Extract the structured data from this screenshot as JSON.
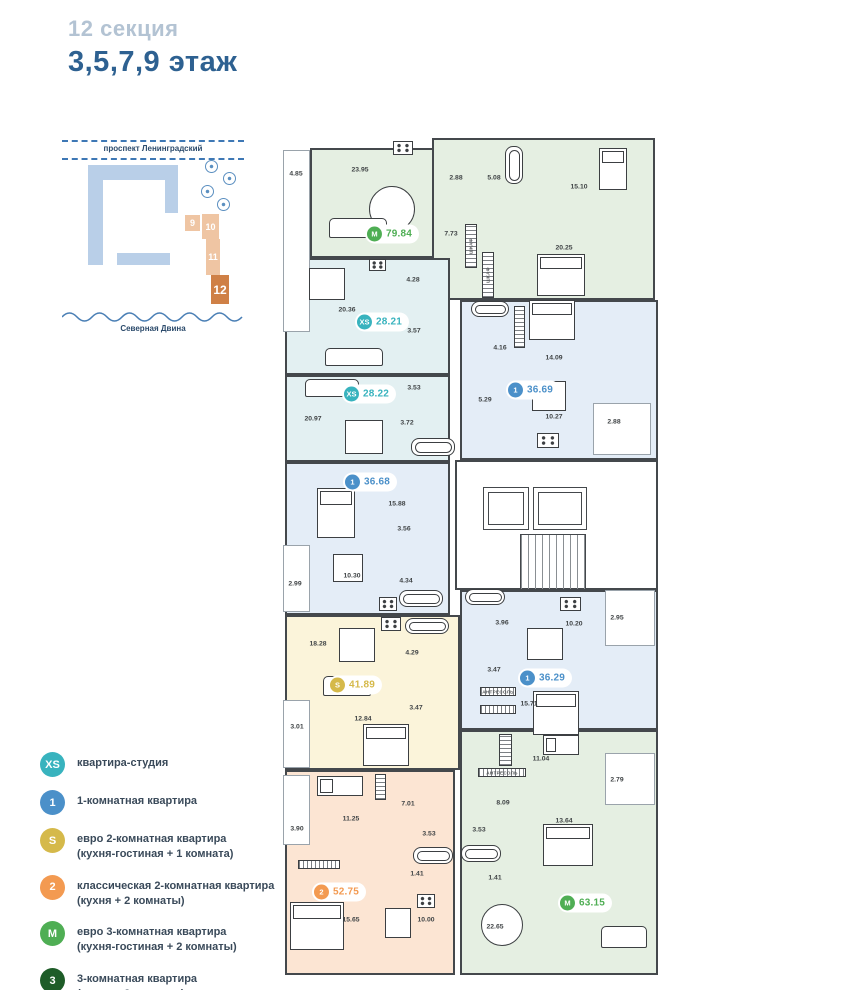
{
  "header": {
    "section_label": "12 секция",
    "floor_label": "3,5,7,9 этаж"
  },
  "site_map": {
    "street_label": "проспект Ленинградский",
    "river_label": "Северная Двина",
    "sections": [
      {
        "label": "9",
        "active": false,
        "x": 123,
        "y": 79,
        "w": 15,
        "h": 16
      },
      {
        "label": "10",
        "active": false,
        "x": 140,
        "y": 78,
        "w": 17,
        "h": 25
      },
      {
        "label": "11",
        "active": false,
        "x": 144,
        "y": 103,
        "w": 14,
        "h": 36
      },
      {
        "label": "12",
        "active": true,
        "x": 149,
        "y": 139,
        "w": 18,
        "h": 29
      }
    ]
  },
  "legend": {
    "items": [
      {
        "code": "XS",
        "color": "#38b3be",
        "line1": "квартира-студия",
        "line2": ""
      },
      {
        "code": "1",
        "color": "#4b90c9",
        "line1": "1-комнатная квартира",
        "line2": ""
      },
      {
        "code": "S",
        "color": "#d5b94a",
        "line1": "евро 2-комнатная квартира",
        "line2": "(кухня-гостиная + 1 комната)"
      },
      {
        "code": "2",
        "color": "#f39a51",
        "line1": "классическая 2-комнатная квартира",
        "line2": "(кухня + 2 комнаты)"
      },
      {
        "code": "M",
        "color": "#4fae54",
        "line1": "евро 3-комнатная квартира",
        "line2": "(кухня-гостиная + 2 комнаты)"
      },
      {
        "code": "3",
        "color": "#1e5c28",
        "line1": "3-комнатная квартира",
        "line2": "(кухня + 3 комнаты)"
      }
    ]
  },
  "types": {
    "XS": {
      "fill": "#e3f0f2",
      "accent": "#38b3be"
    },
    "1": {
      "fill": "#e4edf7",
      "accent": "#4b90c9"
    },
    "S": {
      "fill": "#fbf4da",
      "accent": "#d5b94a"
    },
    "2": {
      "fill": "#fce5d3",
      "accent": "#f39a51"
    },
    "M": {
      "fill": "#e5efe2",
      "accent": "#4fae54"
    }
  },
  "plan": {
    "regions": [
      {
        "k": "M",
        "x": 27,
        "y": 10,
        "w": 150,
        "h": 110
      },
      {
        "k": "M",
        "x": 149,
        "y": 0,
        "w": 223,
        "h": 162
      },
      {
        "k": "XS",
        "x": 2,
        "y": 120,
        "w": 165,
        "h": 117
      },
      {
        "k": "XS",
        "x": 2,
        "y": 237,
        "w": 165,
        "h": 87
      },
      {
        "k": "1",
        "x": 177,
        "y": 162,
        "w": 198,
        "h": 160
      },
      {
        "k": "1",
        "x": 2,
        "y": 324,
        "w": 165,
        "h": 153
      },
      {
        "k": "1",
        "x": 177,
        "y": 452,
        "w": 198,
        "h": 140
      },
      {
        "k": "S",
        "x": 2,
        "y": 477,
        "w": 175,
        "h": 155
      },
      {
        "k": "2",
        "x": 2,
        "y": 632,
        "w": 170,
        "h": 205
      },
      {
        "k": "M",
        "x": 177,
        "y": 592,
        "w": 198,
        "h": 245
      }
    ],
    "balconies": [
      {
        "x": 0,
        "y": 12,
        "w": 27,
        "h": 182
      },
      {
        "x": 310,
        "y": 265,
        "w": 58,
        "h": 52
      },
      {
        "x": 0,
        "y": 407,
        "w": 27,
        "h": 67
      },
      {
        "x": 0,
        "y": 562,
        "w": 27,
        "h": 68
      },
      {
        "x": 322,
        "y": 452,
        "w": 50,
        "h": 56
      },
      {
        "x": 322,
        "y": 615,
        "w": 50,
        "h": 52
      },
      {
        "x": 0,
        "y": 637,
        "w": 27,
        "h": 70
      }
    ],
    "core": {
      "box": {
        "x": 172,
        "y": 322,
        "w": 203,
        "h": 130
      },
      "lifts": [
        {
          "x": 200,
          "y": 349,
          "w": 46,
          "h": 43
        },
        {
          "x": 250,
          "y": 349,
          "w": 54,
          "h": 43
        }
      ],
      "stairs": {
        "x": 237,
        "y": 396,
        "w": 66,
        "h": 56
      }
    },
    "badges": [
      {
        "k": "M",
        "code": "M",
        "area": "79.84",
        "x": 109,
        "y": 96
      },
      {
        "k": "XS",
        "code": "XS",
        "area": "28.21",
        "x": 99,
        "y": 184
      },
      {
        "k": "XS",
        "code": "XS",
        "area": "28.22",
        "x": 86,
        "y": 256
      },
      {
        "k": "1",
        "code": "1",
        "area": "36.69",
        "x": 250,
        "y": 252
      },
      {
        "k": "1",
        "code": "1",
        "area": "36.68",
        "x": 87,
        "y": 344
      },
      {
        "k": "S",
        "code": "S",
        "area": "41.89",
        "x": 72,
        "y": 547
      },
      {
        "k": "1",
        "code": "1",
        "area": "36.29",
        "x": 262,
        "y": 540
      },
      {
        "k": "2",
        "code": "2",
        "area": "52.75",
        "x": 56,
        "y": 754
      },
      {
        "k": "M",
        "code": "M",
        "area": "63.15",
        "x": 302,
        "y": 765
      }
    ],
    "labels": [
      {
        "t": "4.85",
        "x": 13,
        "y": 36
      },
      {
        "t": "23.95",
        "x": 77,
        "y": 32
      },
      {
        "t": "2.88",
        "x": 173,
        "y": 40
      },
      {
        "t": "5.08",
        "x": 211,
        "y": 40
      },
      {
        "t": "15.10",
        "x": 296,
        "y": 49
      },
      {
        "t": "7.73",
        "x": 168,
        "y": 96
      },
      {
        "t": "20.25",
        "x": 281,
        "y": 110
      },
      {
        "t": "20.36",
        "x": 64,
        "y": 172
      },
      {
        "t": "4.28",
        "x": 130,
        "y": 142
      },
      {
        "t": "3.57",
        "x": 131,
        "y": 193
      },
      {
        "t": "3.53",
        "x": 131,
        "y": 250
      },
      {
        "t": "20.97",
        "x": 30,
        "y": 281
      },
      {
        "t": "3.72",
        "x": 124,
        "y": 285
      },
      {
        "t": "4.16",
        "x": 217,
        "y": 210
      },
      {
        "t": "14.09",
        "x": 271,
        "y": 220
      },
      {
        "t": "5.29",
        "x": 202,
        "y": 262
      },
      {
        "t": "10.27",
        "x": 271,
        "y": 279
      },
      {
        "t": "2.88",
        "x": 331,
        "y": 284
      },
      {
        "t": "15.88",
        "x": 114,
        "y": 366
      },
      {
        "t": "3.56",
        "x": 121,
        "y": 391
      },
      {
        "t": "10.30",
        "x": 69,
        "y": 438
      },
      {
        "t": "4.34",
        "x": 123,
        "y": 443
      },
      {
        "t": "2.99",
        "x": 12,
        "y": 446
      },
      {
        "t": "18.28",
        "x": 35,
        "y": 506
      },
      {
        "t": "4.29",
        "x": 129,
        "y": 515
      },
      {
        "t": "3.47",
        "x": 133,
        "y": 570
      },
      {
        "t": "12.84",
        "x": 80,
        "y": 581
      },
      {
        "t": "3.01",
        "x": 14,
        "y": 589
      },
      {
        "t": "3.96",
        "x": 219,
        "y": 485
      },
      {
        "t": "10.20",
        "x": 291,
        "y": 486
      },
      {
        "t": "2.95",
        "x": 334,
        "y": 480
      },
      {
        "t": "3.47",
        "x": 211,
        "y": 532
      },
      {
        "t": "15.71",
        "x": 246,
        "y": 566
      },
      {
        "t": "11.04",
        "x": 258,
        "y": 621
      },
      {
        "t": "2.79",
        "x": 334,
        "y": 642
      },
      {
        "t": "8.09",
        "x": 220,
        "y": 665
      },
      {
        "t": "13.64",
        "x": 281,
        "y": 683
      },
      {
        "t": "3.53",
        "x": 196,
        "y": 692
      },
      {
        "t": "1.41",
        "x": 212,
        "y": 740
      },
      {
        "t": "22.65",
        "x": 212,
        "y": 789
      },
      {
        "t": "11.25",
        "x": 68,
        "y": 681
      },
      {
        "t": "3.90",
        "x": 14,
        "y": 691
      },
      {
        "t": "7.01",
        "x": 125,
        "y": 666
      },
      {
        "t": "3.53",
        "x": 146,
        "y": 696
      },
      {
        "t": "1.41",
        "x": 134,
        "y": 736
      },
      {
        "t": "15.65",
        "x": 68,
        "y": 782
      },
      {
        "t": "10.00",
        "x": 143,
        "y": 782
      }
    ],
    "micro_labels": [
      {
        "t": "ШКАФ",
        "x": 188,
        "y": 108,
        "rot": true
      },
      {
        "t": "ШКАФ",
        "x": 205,
        "y": 137,
        "rot": true
      },
      {
        "t": "АНТРЕСОЛЬ",
        "x": 215,
        "y": 554,
        "rot": false
      },
      {
        "t": "АНТРЕСОЛЬ",
        "x": 219,
        "y": 635,
        "rot": false
      }
    ],
    "furniture": [
      {
        "type": "table-round",
        "x": 86,
        "y": 48,
        "w": 46,
        "h": 46
      },
      {
        "type": "sofa",
        "x": 46,
        "y": 80,
        "w": 58,
        "h": 20
      },
      {
        "type": "stove",
        "x": 110,
        "y": 3,
        "w": 20,
        "h": 14
      },
      {
        "type": "bath",
        "x": 222,
        "y": 8,
        "w": 18,
        "h": 38
      },
      {
        "type": "bed",
        "x": 316,
        "y": 10,
        "w": 28,
        "h": 42
      },
      {
        "type": "bed",
        "x": 254,
        "y": 116,
        "w": 48,
        "h": 42
      },
      {
        "type": "wardrobe",
        "x": 182,
        "y": 86,
        "w": 12,
        "h": 44
      },
      {
        "type": "wardrobe",
        "x": 199,
        "y": 114,
        "w": 12,
        "h": 46
      },
      {
        "type": "table",
        "x": 26,
        "y": 130,
        "w": 36,
        "h": 32
      },
      {
        "type": "sofa",
        "x": 42,
        "y": 210,
        "w": 58,
        "h": 18
      },
      {
        "type": "stove",
        "x": 86,
        "y": 121,
        "w": 17,
        "h": 12
      },
      {
        "type": "sofa",
        "x": 22,
        "y": 241,
        "w": 54,
        "h": 18
      },
      {
        "type": "table",
        "x": 62,
        "y": 282,
        "w": 38,
        "h": 34
      },
      {
        "type": "bath",
        "x": 128,
        "y": 300,
        "w": 44,
        "h": 18
      },
      {
        "type": "bath",
        "x": 188,
        "y": 163,
        "w": 38,
        "h": 16
      },
      {
        "type": "bed",
        "x": 246,
        "y": 162,
        "w": 46,
        "h": 40
      },
      {
        "type": "wardrobe",
        "x": 231,
        "y": 168,
        "w": 11,
        "h": 42
      },
      {
        "type": "table",
        "x": 249,
        "y": 243,
        "w": 34,
        "h": 30
      },
      {
        "type": "stove",
        "x": 254,
        "y": 295,
        "w": 22,
        "h": 15
      },
      {
        "type": "bed",
        "x": 34,
        "y": 350,
        "w": 38,
        "h": 50
      },
      {
        "type": "table",
        "x": 50,
        "y": 416,
        "w": 30,
        "h": 28
      },
      {
        "type": "stove",
        "x": 96,
        "y": 459,
        "w": 18,
        "h": 14
      },
      {
        "type": "bath",
        "x": 116,
        "y": 452,
        "w": 44,
        "h": 17
      },
      {
        "type": "stove",
        "x": 98,
        "y": 479,
        "w": 20,
        "h": 14
      },
      {
        "type": "bath",
        "x": 122,
        "y": 480,
        "w": 44,
        "h": 16
      },
      {
        "type": "table",
        "x": 56,
        "y": 490,
        "w": 36,
        "h": 34
      },
      {
        "type": "sofa",
        "x": 40,
        "y": 538,
        "w": 48,
        "h": 20
      },
      {
        "type": "bed",
        "x": 80,
        "y": 586,
        "w": 46,
        "h": 42
      },
      {
        "type": "bath",
        "x": 182,
        "y": 451,
        "w": 40,
        "h": 16
      },
      {
        "type": "stove",
        "x": 277,
        "y": 459,
        "w": 21,
        "h": 14
      },
      {
        "type": "table",
        "x": 244,
        "y": 490,
        "w": 36,
        "h": 32
      },
      {
        "type": "bed",
        "x": 250,
        "y": 553,
        "w": 46,
        "h": 44
      },
      {
        "type": "antresol",
        "x": 197,
        "y": 549,
        "w": 36,
        "h": 9
      },
      {
        "type": "antresol",
        "x": 197,
        "y": 567,
        "w": 36,
        "h": 9
      },
      {
        "type": "bed-s",
        "x": 260,
        "y": 597,
        "w": 36,
        "h": 20
      },
      {
        "type": "wardrobe",
        "x": 216,
        "y": 596,
        "w": 13,
        "h": 32
      },
      {
        "type": "antresol",
        "x": 195,
        "y": 630,
        "w": 48,
        "h": 9
      },
      {
        "type": "bed",
        "x": 260,
        "y": 686,
        "w": 50,
        "h": 42
      },
      {
        "type": "bath",
        "x": 178,
        "y": 707,
        "w": 40,
        "h": 17
      },
      {
        "type": "table-round",
        "x": 198,
        "y": 766,
        "w": 42,
        "h": 42
      },
      {
        "type": "sofa",
        "x": 318,
        "y": 788,
        "w": 46,
        "h": 22
      },
      {
        "type": "bed-s",
        "x": 34,
        "y": 638,
        "w": 46,
        "h": 20
      },
      {
        "type": "wardrobe",
        "x": 92,
        "y": 636,
        "w": 11,
        "h": 26
      },
      {
        "type": "antresol",
        "x": 15,
        "y": 722,
        "w": 42,
        "h": 9
      },
      {
        "type": "bath",
        "x": 130,
        "y": 709,
        "w": 40,
        "h": 17
      },
      {
        "type": "bed",
        "x": 7,
        "y": 764,
        "w": 54,
        "h": 48
      },
      {
        "type": "stove",
        "x": 134,
        "y": 756,
        "w": 18,
        "h": 14
      },
      {
        "type": "table",
        "x": 102,
        "y": 770,
        "w": 26,
        "h": 30
      }
    ]
  }
}
